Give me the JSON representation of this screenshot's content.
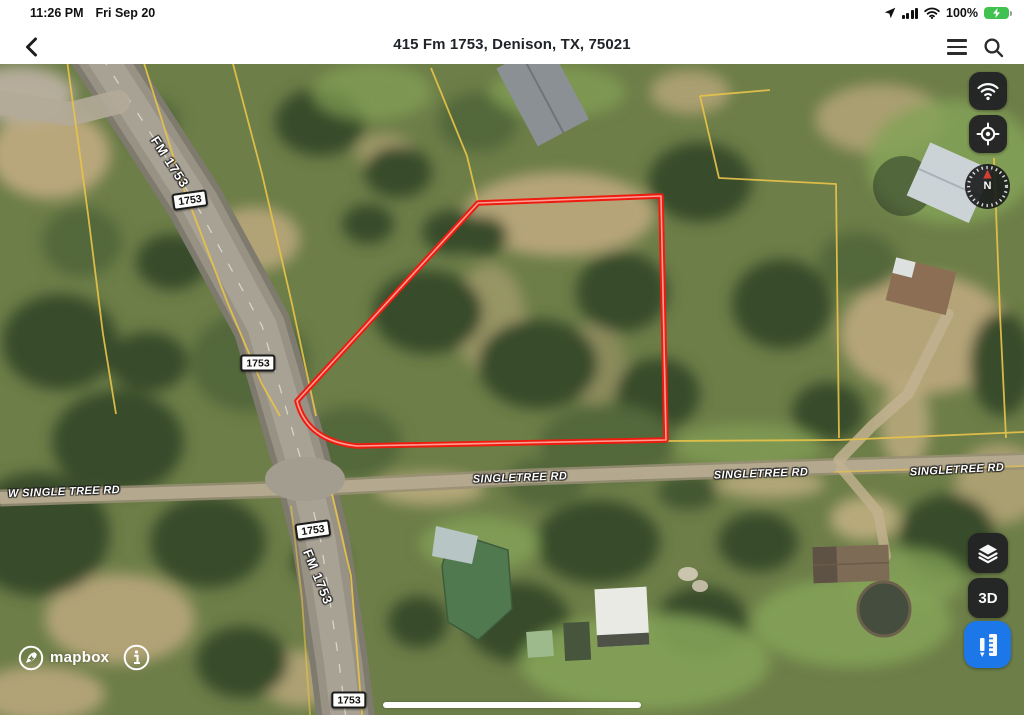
{
  "status_bar": {
    "time": "11:26 PM",
    "date": "Fri Sep 20",
    "battery_percent": "100%"
  },
  "nav_bar": {
    "title": "415 Fm 1753, Denison, TX, 75021"
  },
  "map": {
    "attribution": "mapbox",
    "info_glyph": "i",
    "labels": {
      "highway_name": "FM 1753",
      "route_shield": "1753",
      "singletree_rd": "SINGLETREE RD",
      "w_single_tree_rd": "W SINGLE TREE RD"
    },
    "controls": {
      "compass_north": "N",
      "view_3d": "3D"
    },
    "colors": {
      "property_outline": "#ee1b0f",
      "parcel_line": "#e8c24a",
      "measure_button": "#1a78f0",
      "control_button_bg": "#232325"
    }
  }
}
